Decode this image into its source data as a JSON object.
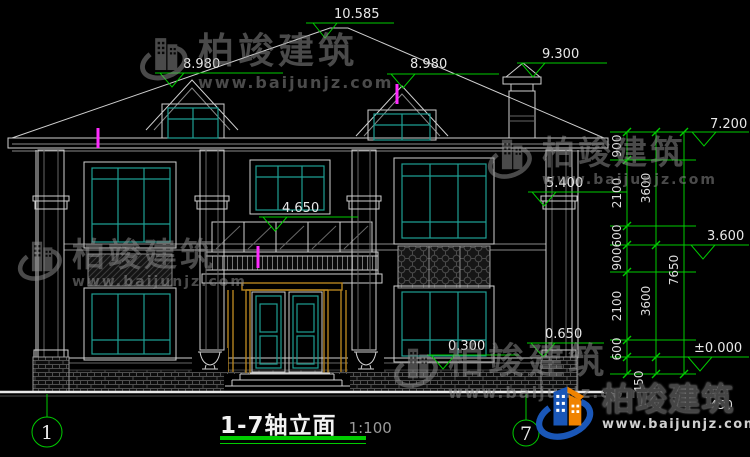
{
  "drawing": {
    "title": "1-7轴立面",
    "scale": "1:100"
  },
  "levels": {
    "ridge": "10.585",
    "dormer_left": "8.980",
    "dormer_right": "8.980",
    "chimney": "9.300",
    "eave_right": "7.200",
    "porch_eave": "5.400",
    "balcony_top": "4.650",
    "second_floor": "3.600",
    "plinth_right": "0.650",
    "window_sill": "0.300",
    "ground_zero": "±0.000"
  },
  "dims": {
    "t1s1": "900",
    "t1s2": "2100",
    "t1s3": "600",
    "t1s4": "900",
    "t1s5": "2100",
    "t1s6": "600",
    "t1s7": "450",
    "t2s1": "3600",
    "t2s2": "3600",
    "t2s3": "450",
    "t3s1": "7650"
  },
  "axes": {
    "left": "1",
    "right": "7"
  },
  "brand": {
    "name": "柏竣建筑",
    "url": "www.baijunjz.com"
  },
  "colors": {
    "background": "#000000",
    "line_white": "#cfcfcf",
    "window_teal": "#1e9e93",
    "dim_green": "#00cc00",
    "frame_orange": "#b5831f",
    "marker_magenta": "#ff2bff",
    "watermark_gray": "#8f8f8f",
    "logo_blue": "#1a57b8",
    "logo_orange": "#f08300"
  }
}
